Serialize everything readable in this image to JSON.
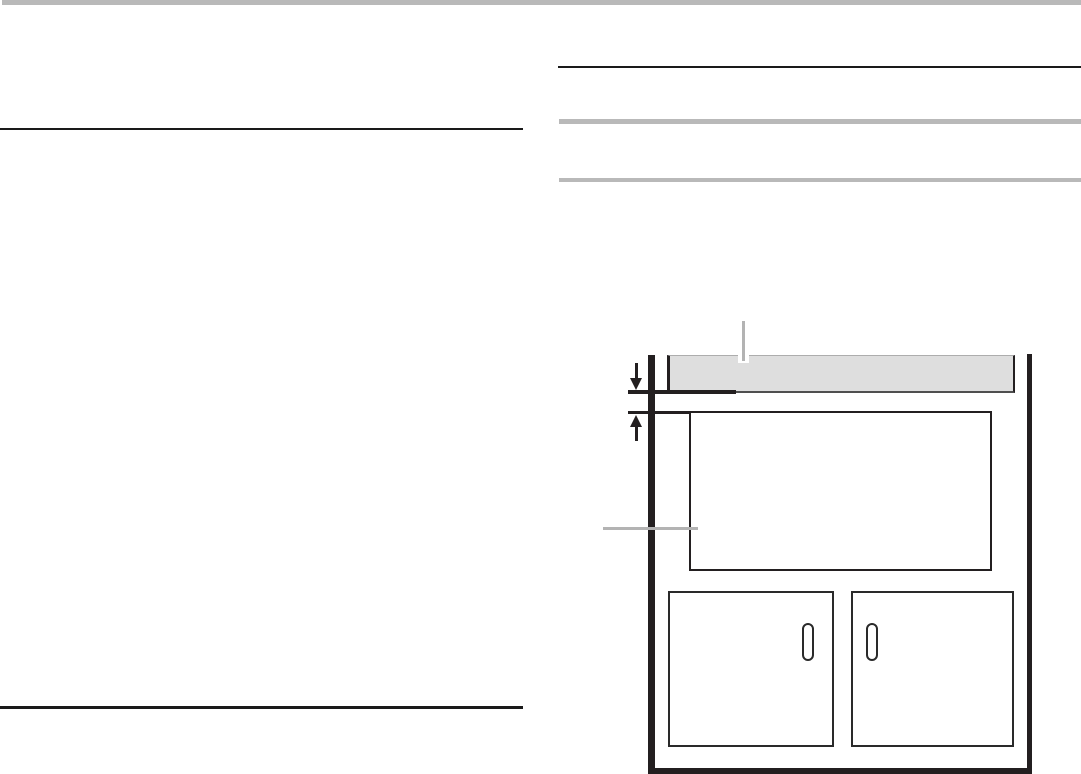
{
  "page": {
    "kind": "scanned-manual-page",
    "description": "Blank two-column appliance manual page: gray top bar, black section rules, two gray header bars in the right column, and a cabinet cutout installation figure. No readable text is rendered on the page.",
    "visible_text": ""
  },
  "colors": {
    "page_white": "#ffffff",
    "bar_gray": "#b9b9b9",
    "rule_black": "#1a1a1a",
    "figure_line": "#231f20",
    "door_line": "#2a2a2a",
    "strip_fill": "#dedede",
    "strip_edge": "#4f4f4f",
    "strip_top_edge": "#adadad",
    "callout_gray": "#b3b3b3"
  },
  "left_column": {
    "rules": [
      {
        "name": "section-rule-top"
      },
      {
        "name": "section-rule-bottom"
      }
    ]
  },
  "right_column": {
    "rule": {
      "name": "section-rule"
    },
    "header_bars": [
      {
        "name": "header-bar-1"
      },
      {
        "name": "header-bar-2"
      }
    ]
  },
  "figure": {
    "name": "cabinet-cutout-installation-diagram",
    "elements": [
      {
        "name": "counter-strip",
        "shape": "shaded horizontal strip with dark edges"
      },
      {
        "name": "counter-strip-callout-leader",
        "shape": "vertical gray leader line"
      },
      {
        "name": "clearance-dimension-arrows",
        "shape": "opposing down/up arrows across a narrow gap"
      },
      {
        "name": "cutout-opening",
        "shape": "large outlined rectangle"
      },
      {
        "name": "cutout-callout-leader",
        "shape": "horizontal gray leader line"
      },
      {
        "name": "cabinet-left-wall",
        "shape": "thick vertical line"
      },
      {
        "name": "cabinet-right-wall",
        "shape": "thick vertical line"
      },
      {
        "name": "cabinet-bottom-rail",
        "shape": "thick horizontal line"
      },
      {
        "name": "cabinet-door-left",
        "handle": "door-handle-left"
      },
      {
        "name": "cabinet-door-right",
        "handle": "door-handle-right"
      }
    ]
  }
}
